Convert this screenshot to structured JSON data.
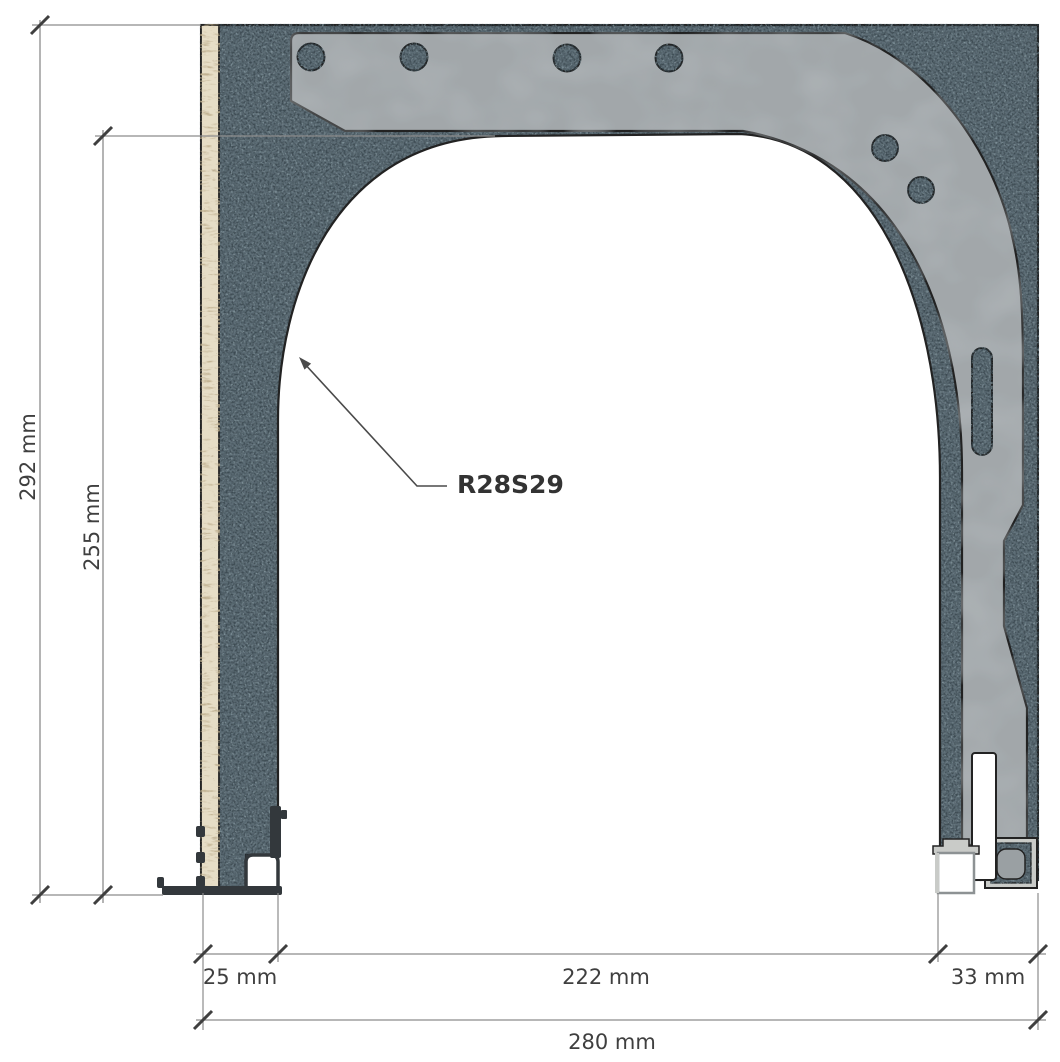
{
  "figure": {
    "type": "technical-cross-section",
    "profile_label": "R28S29",
    "dims": {
      "total_height": "292 mm",
      "opening_height": "255 mm",
      "left_jamb": "25 mm",
      "clear_opening": "222 mm",
      "guide_rail": "33 mm",
      "total_width": "280 mm"
    },
    "colors": {
      "insulation_base": "#5d6d76",
      "insulation_speck_dark": "#37444b",
      "insulation_speck_light": "#8da0a8",
      "steel_bracket": "#a2a7aa",
      "aluminium_profile": "#c9cbc8",
      "seal_core": "#9aa0a3",
      "wood_base": "#e6ddc6",
      "wood_grain": "#8a7349",
      "dark_profile": "#33383c",
      "outline": "#222222",
      "dim_text": "#3f3f3f",
      "dim_line": "#8c8c8c",
      "background": "#ffffff"
    }
  }
}
